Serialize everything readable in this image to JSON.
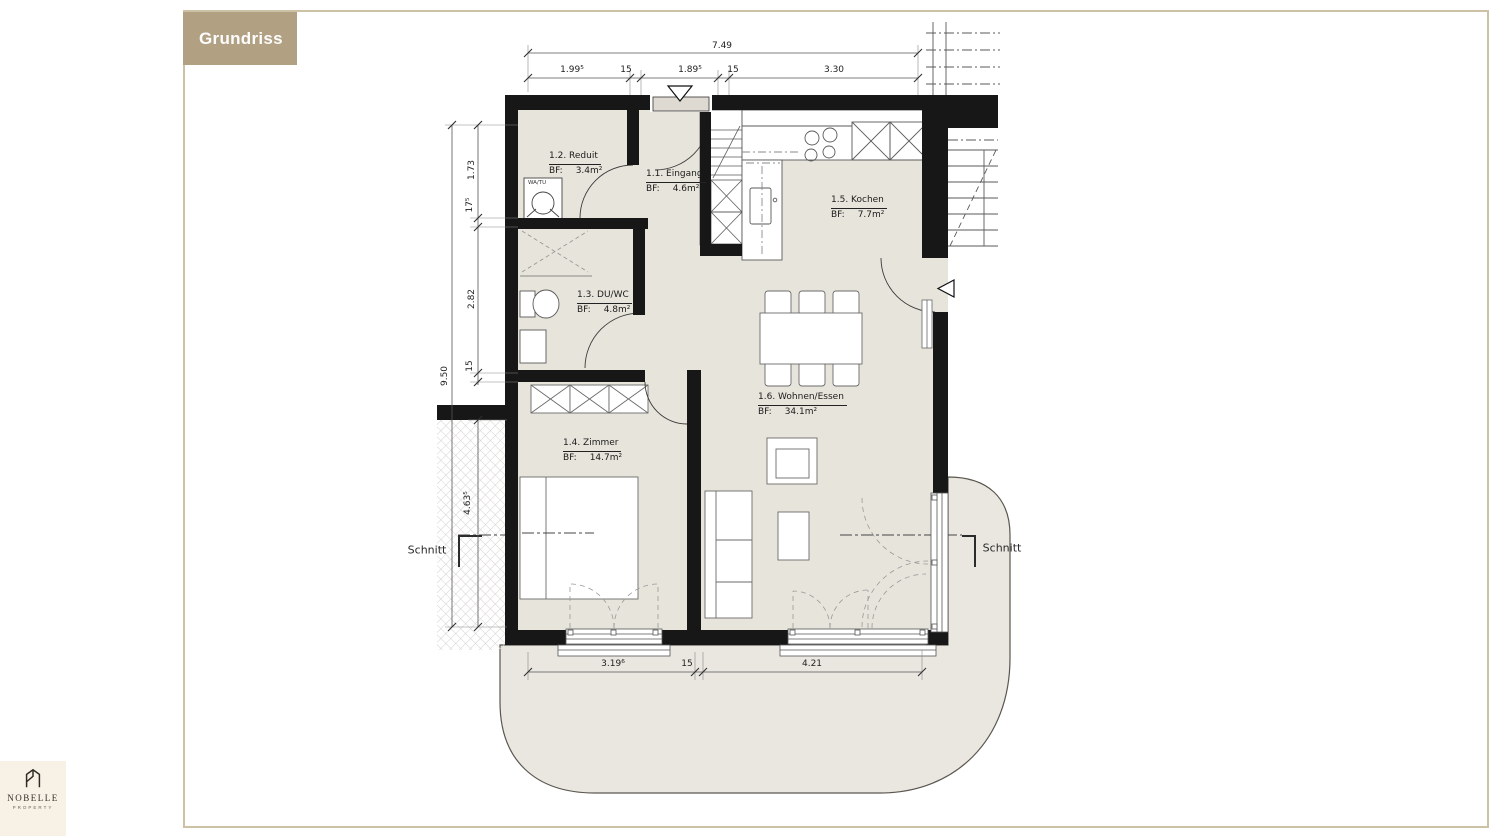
{
  "header": {
    "title": "Grundriss"
  },
  "brand": {
    "name": "NOBELLE",
    "subtitle": "PROPERTY"
  },
  "plan": {
    "area_prefix": "BF:",
    "rooms": {
      "eingang": {
        "name": "1.1. Eingang",
        "area": "4.6m²"
      },
      "reduit": {
        "name": "1.2. Reduit",
        "area": "3.4m²"
      },
      "duwc": {
        "name": "1.3. DU/WC",
        "area": "4.8m²"
      },
      "zimmer": {
        "name": "1.4. Zimmer",
        "area": "14.7m²"
      },
      "kochen": {
        "name": "1.5. Kochen",
        "area": "7.7m²"
      },
      "wohnen": {
        "name": "1.6. Wohnen/Essen",
        "area": "34.1m²"
      }
    },
    "appliances": {
      "washer": "WA/TU"
    },
    "section_label": "Schnitt",
    "dims": {
      "top_total": "7.49",
      "top_chain": {
        "a": "1.99⁵",
        "b": "15",
        "c": "1.89⁵",
        "d": "15",
        "e": "3.30"
      },
      "left_total": "9.50",
      "left_chain": {
        "a": "1.73",
        "b": "17⁵",
        "c": "2.82",
        "d": "15"
      },
      "left_lower": "4.63⁵",
      "bottom_chain": {
        "a": "3.19⁶",
        "b": "15",
        "c": "4.21"
      }
    }
  },
  "colors": {
    "accent": "#b2a083",
    "page_border": "#cdc1a6",
    "wall": "#171717",
    "floor": "#e7e4db",
    "terrace": "#eae7e0",
    "logo_bg": "#f7f1e6"
  }
}
